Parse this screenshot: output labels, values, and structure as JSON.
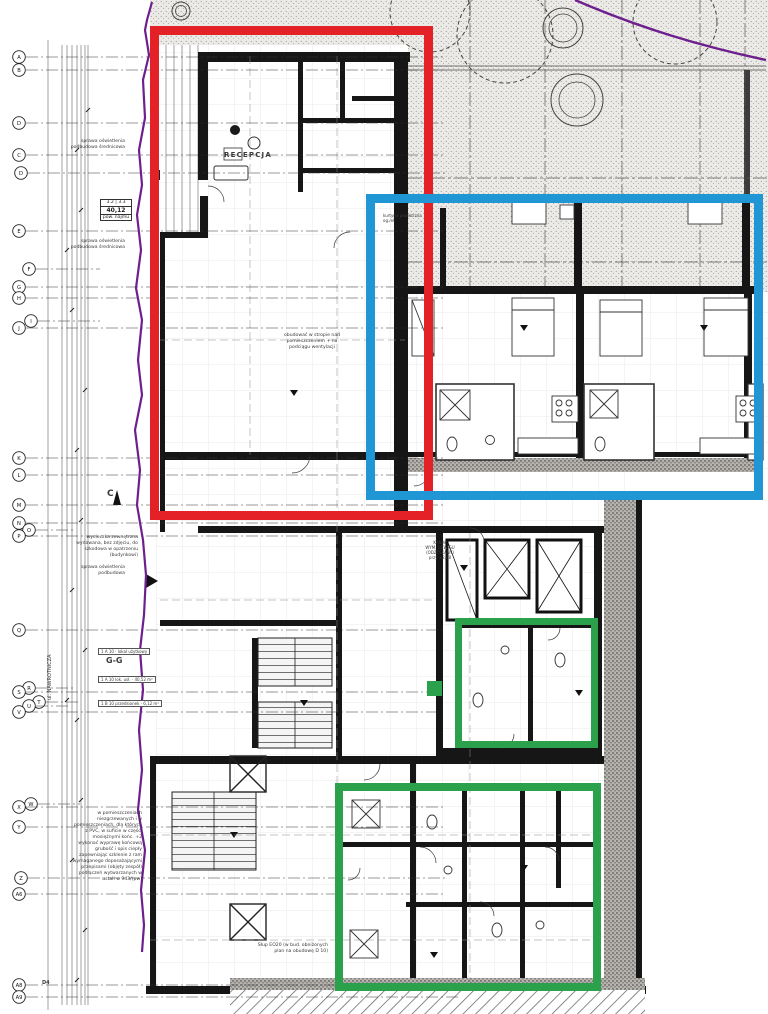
{
  "colors": {
    "red": "#e32127",
    "blue": "#2097d4",
    "green": "#2ca14b",
    "purple": "#6d1f8e"
  },
  "area_box": {
    "l1": "3.2 | 3.3",
    "l2": "40,12",
    "l3": "pow. najmu"
  },
  "grid_markers": [
    {
      "label": "A",
      "x": 19,
      "y": 57,
      "lx": 445
    },
    {
      "label": "B",
      "x": 19,
      "y": 70,
      "lx": 445
    },
    {
      "label": "D",
      "x": 19,
      "y": 123,
      "lx": 445
    },
    {
      "label": "C",
      "x": 19,
      "y": 155,
      "lx": 445
    },
    {
      "label": "D",
      "x": 21,
      "y": 173,
      "lx": 445
    },
    {
      "label": "E",
      "x": 19,
      "y": 231,
      "lx": 445
    },
    {
      "label": "F",
      "x": 29,
      "y": 269,
      "lx": 100
    },
    {
      "label": "G",
      "x": 19,
      "y": 287,
      "lx": 445
    },
    {
      "label": "H",
      "x": 19,
      "y": 298,
      "lx": 445
    },
    {
      "label": "I",
      "x": 31,
      "y": 321,
      "lx": 100
    },
    {
      "label": "J",
      "x": 19,
      "y": 328,
      "lx": 445
    },
    {
      "label": "K",
      "x": 19,
      "y": 458,
      "lx": 445
    },
    {
      "label": "L",
      "x": 19,
      "y": 475,
      "lx": 445
    },
    {
      "label": "M",
      "x": 19,
      "y": 505,
      "lx": 445
    },
    {
      "label": "N",
      "x": 19,
      "y": 523,
      "lx": 445
    },
    {
      "label": "O",
      "x": 29,
      "y": 530,
      "lx": 75
    },
    {
      "label": "P",
      "x": 19,
      "y": 536,
      "lx": 445
    },
    {
      "label": "Q",
      "x": 19,
      "y": 630,
      "lx": 445
    },
    {
      "label": "R",
      "x": 29,
      "y": 688,
      "lx": 75
    },
    {
      "label": "S",
      "x": 19,
      "y": 692,
      "lx": 445
    },
    {
      "label": "T",
      "x": 39,
      "y": 702,
      "lx": 80
    },
    {
      "label": "U",
      "x": 29,
      "y": 706,
      "lx": 70
    },
    {
      "label": "V",
      "x": 19,
      "y": 712,
      "lx": 445
    },
    {
      "label": "W",
      "x": 31,
      "y": 804,
      "lx": 80
    },
    {
      "label": "X",
      "x": 19,
      "y": 807,
      "lx": 445
    },
    {
      "label": "Y",
      "x": 19,
      "y": 827,
      "lx": 445
    },
    {
      "label": "Z",
      "x": 21,
      "y": 878,
      "lx": 445
    },
    {
      "label": "A6",
      "x": 19,
      "y": 894,
      "lx": 445
    },
    {
      "label": "A8",
      "x": 19,
      "y": 985,
      "lx": 460
    },
    {
      "label": "A9",
      "x": 19,
      "y": 997,
      "lx": 460
    }
  ],
  "annotations": [
    {
      "t": "RECEPCJA",
      "x": 224,
      "y": 152,
      "s": 7,
      "b": 1,
      "ls": 1.2
    },
    {
      "t": "G-G",
      "x": 106,
      "y": 657,
      "s": 8,
      "b": 1
    },
    {
      "t": "C",
      "x": 107,
      "y": 490,
      "s": 9,
      "b": 1
    },
    {
      "t": "D4",
      "x": 42,
      "y": 981,
      "s": 5,
      "b": 1
    },
    {
      "t": "sprawa oświetlenia",
      "x": 60,
      "y": 140,
      "w": 65,
      "a": "r"
    },
    {
      "t": "podbudowa średnicowa",
      "x": 60,
      "y": 146,
      "w": 65,
      "a": "r"
    },
    {
      "t": "sprawa oświetlenia",
      "x": 60,
      "y": 240,
      "w": 65,
      "a": "r"
    },
    {
      "t": "podbudowa średnicowa",
      "x": 60,
      "y": 246,
      "w": 65,
      "a": "r"
    },
    {
      "t": "sprawa oświetlenia",
      "x": 60,
      "y": 566,
      "w": 65,
      "a": "r"
    },
    {
      "t": "podbudowa",
      "x": 60,
      "y": 572,
      "w": 65,
      "a": "r"
    },
    {
      "t": "wycieczka zewnętrzna",
      "x": 70,
      "y": 536,
      "w": 68,
      "a": "r"
    },
    {
      "t": "wydawana, bez zdjęciu, do",
      "x": 70,
      "y": 542,
      "w": 68,
      "a": "r"
    },
    {
      "t": "szkodowa w opatrzeniu",
      "x": 70,
      "y": 548,
      "w": 68,
      "a": "r"
    },
    {
      "t": "(budynkowi)",
      "x": 70,
      "y": 554,
      "w": 68,
      "a": "r"
    },
    {
      "t": "ul. NAWROTNICZA",
      "x": 48,
      "y": 700,
      "r": -90,
      "s": 5
    },
    {
      "t": "obudować w stropie nad",
      "x": 284,
      "y": 334,
      "w": 56,
      "a": "c"
    },
    {
      "t": "pomieszczeniem + na",
      "x": 284,
      "y": 340,
      "w": 56,
      "a": "c"
    },
    {
      "t": "podciągu wentylacji",
      "x": 284,
      "y": 346,
      "w": 56,
      "a": "c"
    },
    {
      "t": "w pomieszczeniach",
      "x": 66,
      "y": 812,
      "w": 76,
      "a": "r"
    },
    {
      "t": "niezgrzewanych i w",
      "x": 66,
      "y": 818,
      "w": 76,
      "a": "r"
    },
    {
      "t": "pomieszczeniach, dla których",
      "x": 66,
      "y": 824,
      "w": 76,
      "a": "r"
    },
    {
      "t": "z PVC, w suficie w części",
      "x": 66,
      "y": 830,
      "w": 76,
      "a": "r"
    },
    {
      "t": "mosiężnymi końc. +2",
      "x": 66,
      "y": 836,
      "w": 76,
      "a": "r"
    },
    {
      "t": "wykonać wyprawę końcową",
      "x": 66,
      "y": 842,
      "w": 76,
      "a": "r"
    },
    {
      "t": "grubość i opis ciepły",
      "x": 66,
      "y": 848,
      "w": 76,
      "a": "r"
    },
    {
      "t": "zapewniając szklenie z ram",
      "x": 66,
      "y": 854,
      "w": 76,
      "a": "r"
    },
    {
      "t": "wymaganego doposażającymi",
      "x": 66,
      "y": 860,
      "w": 76,
      "a": "r"
    },
    {
      "t": "przepisami (objęty zespół)",
      "x": 66,
      "y": 866,
      "w": 76,
      "a": "r"
    },
    {
      "t": "podłączeń wytwarzanych w",
      "x": 66,
      "y": 872,
      "w": 76,
      "a": "r"
    },
    {
      "t": "ustali w 943/(pw)",
      "x": 66,
      "y": 878,
      "w": 76,
      "a": "r"
    },
    {
      "t": "Słup EO20 (w bud. obniżonych",
      "x": 250,
      "y": 944,
      "w": 78,
      "a": "r"
    },
    {
      "t": "plan na obudowę D 10)",
      "x": 250,
      "y": 950,
      "w": 78,
      "a": "r"
    },
    {
      "t": "KANAŁ",
      "x": 420,
      "y": 541,
      "w": 40,
      "a": "c",
      "s": 4
    },
    {
      "t": "WYM. DŹWIGU",
      "x": 420,
      "y": 546,
      "w": 40,
      "a": "c",
      "s": 4
    },
    {
      "t": "(ODZYSKANY)",
      "x": 420,
      "y": 551,
      "w": 40,
      "a": "c",
      "s": 4
    },
    {
      "t": "przy +2,08",
      "x": 420,
      "y": 556,
      "w": 40,
      "a": "c",
      "s": 4
    },
    {
      "t": "kurtyna powietrzna",
      "x": 383,
      "y": 214,
      "s": 4
    },
    {
      "t": "og./el.",
      "x": 383,
      "y": 219,
      "s": 4
    },
    {
      "t": "1 A 10 · lokal użytkowy",
      "x": 98,
      "y": 648,
      "s": 4,
      "box": 1
    },
    {
      "t": "1 A 10 lok. usł. · 40,52 m²",
      "x": 98,
      "y": 676,
      "s": 4,
      "box": 1
    },
    {
      "t": "1 B 10 przedsionek · 6,12 m²",
      "x": 98,
      "y": 700,
      "s": 4,
      "box": 1
    }
  ]
}
